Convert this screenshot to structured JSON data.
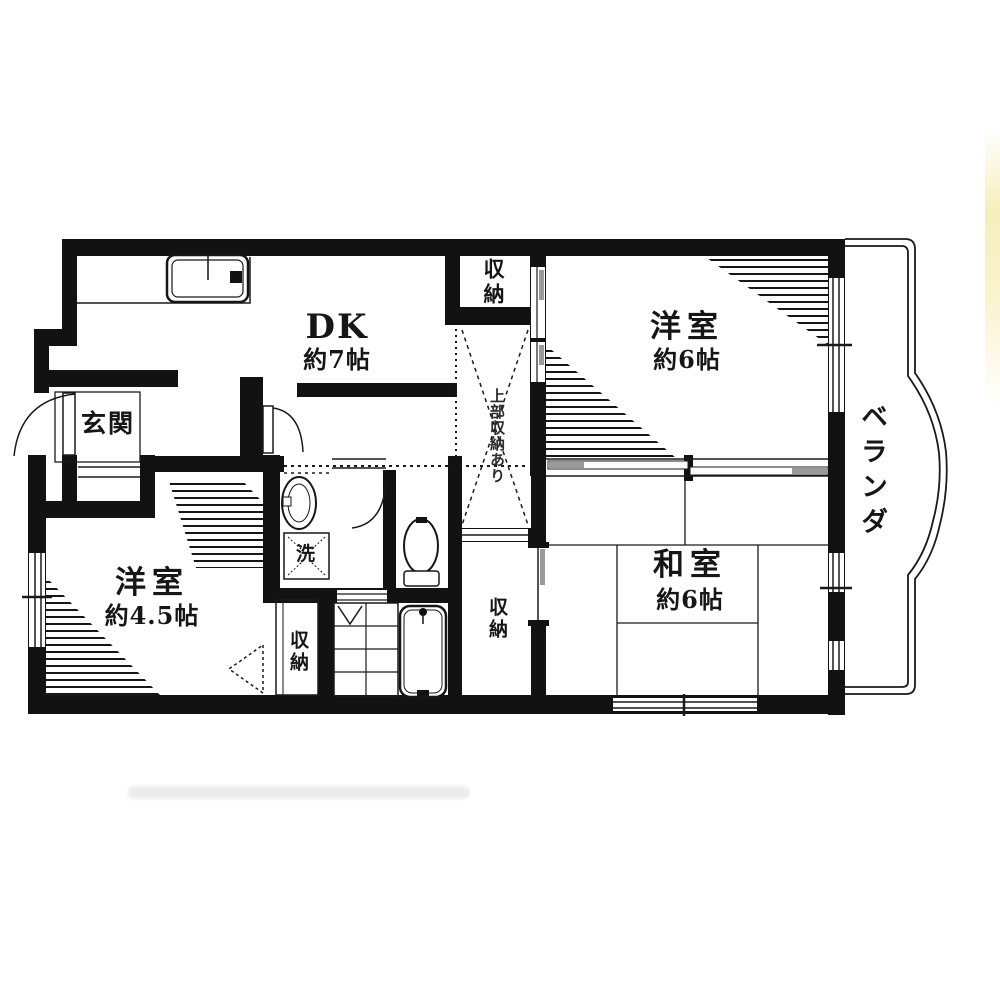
{
  "floor_plan": {
    "rooms": [
      {
        "id": "dk",
        "name": "DK",
        "size": "約7帖"
      },
      {
        "id": "western-room-6",
        "name": "洋室",
        "size": "約6帖"
      },
      {
        "id": "japanese-room",
        "name": "和室",
        "size": "約6帖"
      },
      {
        "id": "western-room-45",
        "name": "洋室",
        "size": "約4.5帖"
      },
      {
        "id": "entrance",
        "name": "玄関"
      },
      {
        "id": "veranda",
        "name": "ベランダ"
      }
    ],
    "storage": {
      "top": "収納",
      "bottom_left": "収納",
      "bottom_right": "収納",
      "upper_note": "上部収納あり"
    },
    "fixtures": {
      "laundry": "洗"
    }
  },
  "colors": {
    "wall": "#121212",
    "background": "#ffffff",
    "thin_line": "#1a1a1a",
    "shade_gray": "#9a9a9a",
    "edge_strip": "#f6eebb"
  }
}
